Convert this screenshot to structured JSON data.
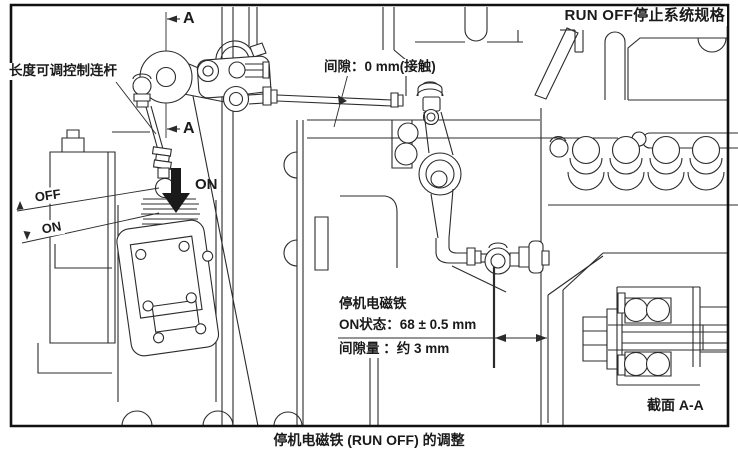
{
  "figure": {
    "title": "RUN OFF停止系统规格",
    "caption": "停机电磁铁 (RUN OFF) 的调整",
    "section_label": "截面 A-A",
    "section_marker": "A"
  },
  "labels": {
    "linkage": "长度可调控制连杆",
    "gap": "间隙：0 mm(接触)",
    "off": "OFF",
    "on": "ON",
    "on_arrow": "ON"
  },
  "solenoid_spec": {
    "name": "停机电磁铁",
    "on_state": "ON状态：68 ± 0.5 mm",
    "clearance": "间隙量 ：约 3 mm"
  },
  "icons": {
    "on_direction": "down-arrow-icon",
    "section_cut": "left-arrow-icon"
  },
  "colors": {
    "line": "#2b2b2b",
    "background": "#ffffff",
    "border": "#111111"
  }
}
